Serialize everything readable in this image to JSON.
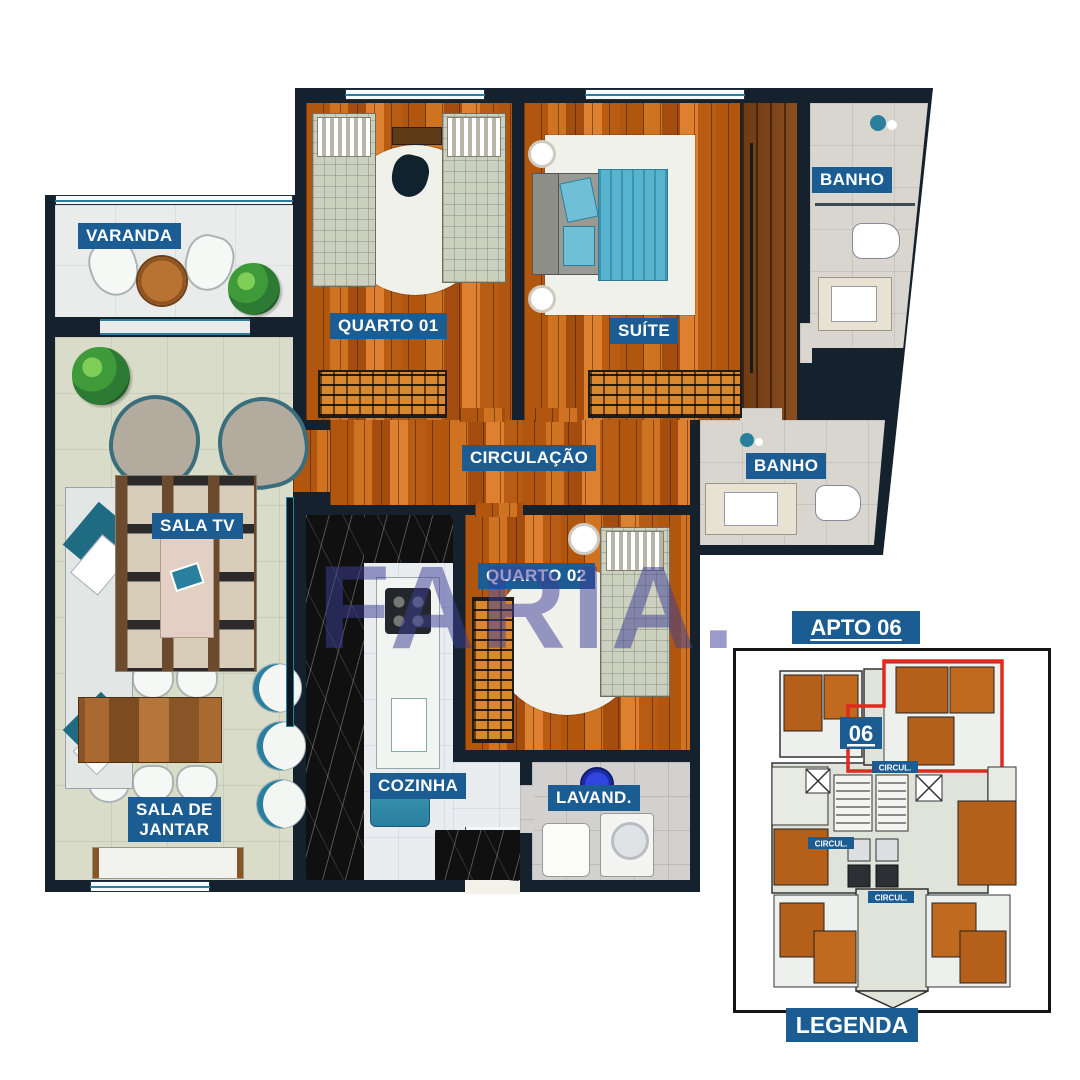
{
  "floorplan": {
    "rooms": {
      "varanda": {
        "label": "VARANDA"
      },
      "quarto01": {
        "label": "QUARTO 01"
      },
      "suite": {
        "label": "SUÍTE"
      },
      "banho1": {
        "label": "BANHO"
      },
      "circulacao": {
        "label": "CIRCULAÇÃO"
      },
      "banho2": {
        "label": "BANHO"
      },
      "sala_tv": {
        "label": "SALA TV"
      },
      "quarto02": {
        "label": "QUARTO 02"
      },
      "cozinha": {
        "label": "COZINHA"
      },
      "lavanderia": {
        "label": "LAVAND."
      },
      "sala_jantar": {
        "lines": [
          "SALA DE",
          "JANTAR"
        ]
      }
    },
    "watermark": "FARIA."
  },
  "keyplan": {
    "title": "APTO 06",
    "unit_badge": "06",
    "circulation_labels": [
      "CIRCUL.",
      "CIRCUL.",
      "CIRCUL."
    ],
    "legend_label": "LEGENDA"
  },
  "colors": {
    "wall": "#15222d",
    "label_background": "#1b5c93",
    "label_text": "#ffffff",
    "wood_floor": "#c06a1e",
    "living_tile": "#d8dcc8",
    "bath_tile": "#d9d6cf",
    "kitchen_tile": "#e9edf0",
    "teal_accent": "#2a7f9e",
    "bed_teal": "#57b4cf",
    "unit_outline_red": "#e12a1e",
    "watermark": "#3e4096"
  }
}
